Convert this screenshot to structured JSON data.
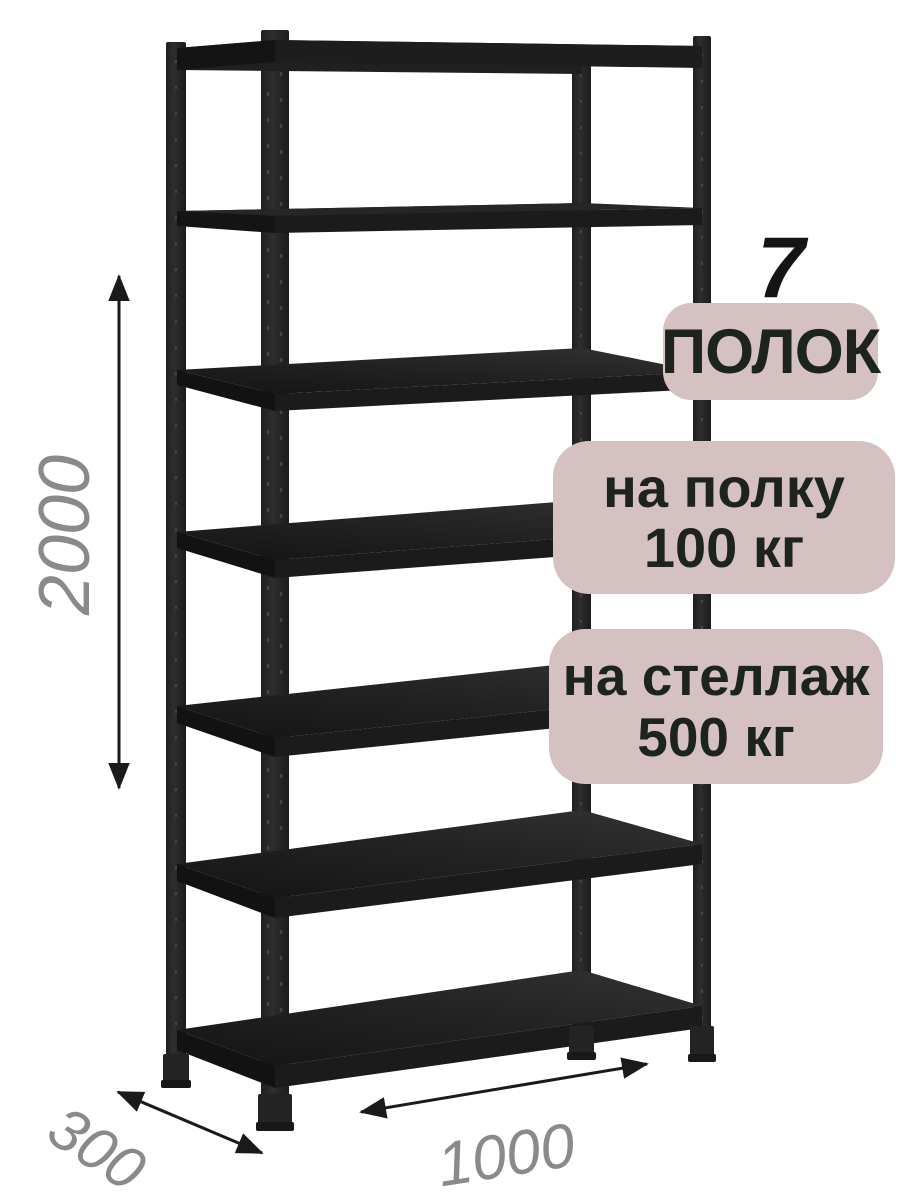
{
  "image": {
    "background": "#ffffff"
  },
  "badges": {
    "bg_color": "#d5c1c1",
    "text_color": "#1d231d",
    "shelves": {
      "number": "7",
      "label": "ПОЛОК"
    },
    "per_shelf": {
      "line1": "на полку",
      "line2": "100 кг"
    },
    "per_rack": {
      "line1": "на стеллаж",
      "line2": "500 кг"
    }
  },
  "dimensions": {
    "height_mm": "2000",
    "depth_mm": "300",
    "width_mm": "1000",
    "label_color": "#8a8a8a",
    "arrow_color": "#1a1a1a"
  },
  "rack": {
    "shelf_count": 7,
    "color_post": "#282828",
    "color_shelf_dark": "#121212",
    "color_shelf_light": "#2e2e2e"
  }
}
